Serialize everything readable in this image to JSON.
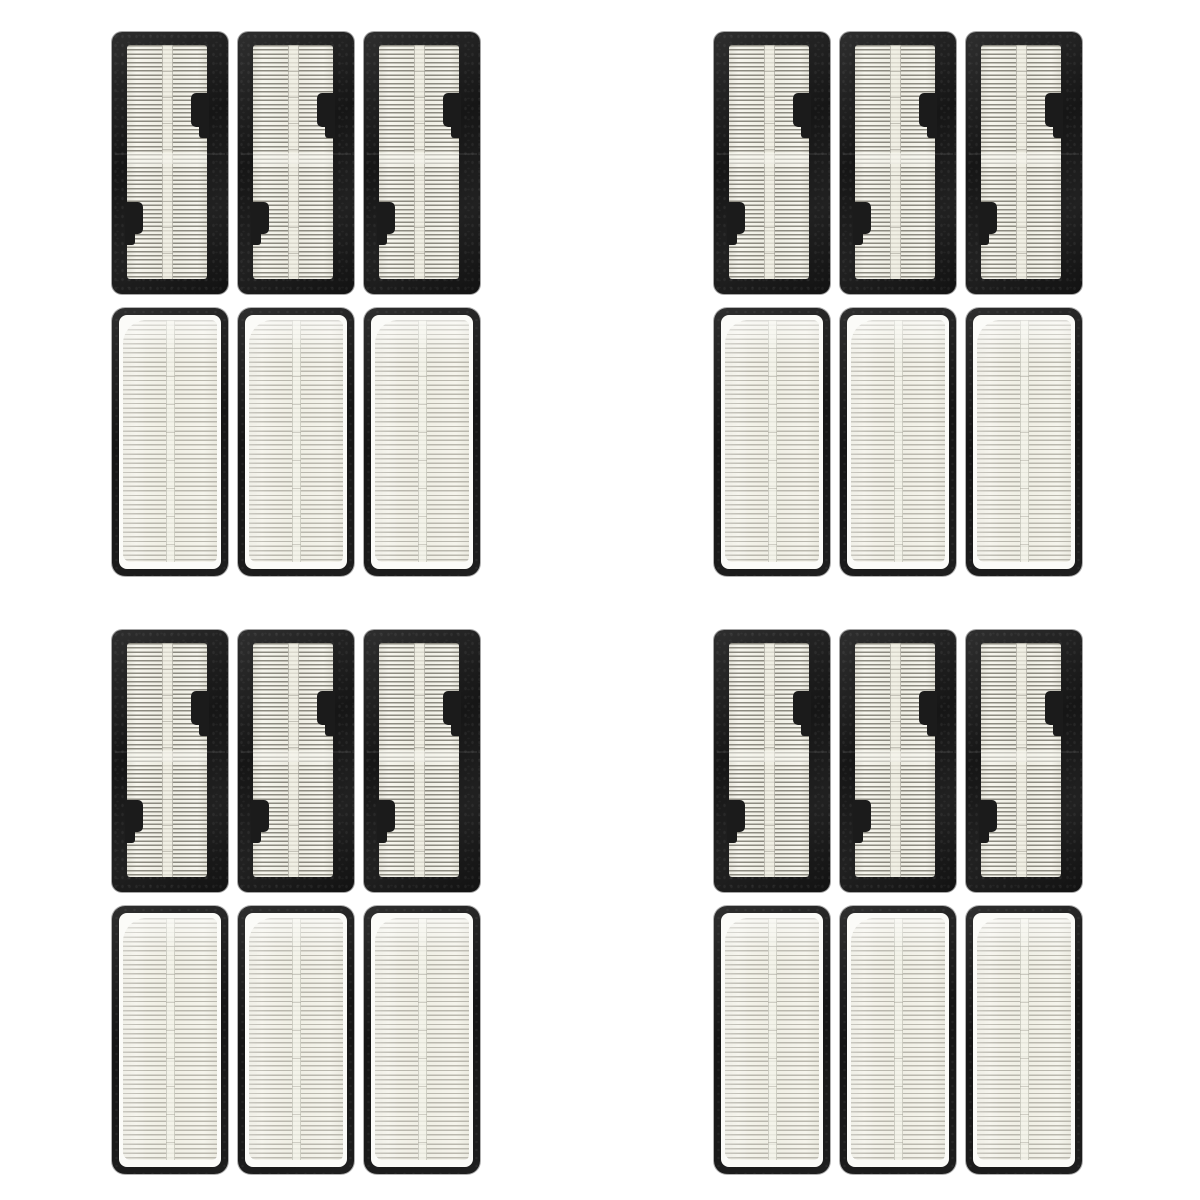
{
  "photo": {
    "subject": "Product photo of replacement robot-vacuum HEPA filters shown front and back, no text",
    "group_count": 4,
    "filters_per_group": 6,
    "total_filters": 24
  },
  "grid": {
    "filters_per_row": 3,
    "row_views": [
      "front-framed",
      "back-pleated"
    ],
    "groups": [
      {
        "name": "filter-group-top-left"
      },
      {
        "name": "filter-group-top-right"
      },
      {
        "name": "filter-group-bottom-left"
      },
      {
        "name": "filter-group-bottom-right"
      }
    ]
  },
  "colors": {
    "background": "#ffffff",
    "frame_black": "#1b1b1b",
    "frame_black_highlight": "#2e2e2e",
    "media_ivory": "#f3f2ea",
    "pleat_line_front": "#8c8a80",
    "pleat_line_back": "#bab8ae",
    "divider_ivory": "#f0eee1",
    "inner_margin_white": "#fbfbf8"
  }
}
